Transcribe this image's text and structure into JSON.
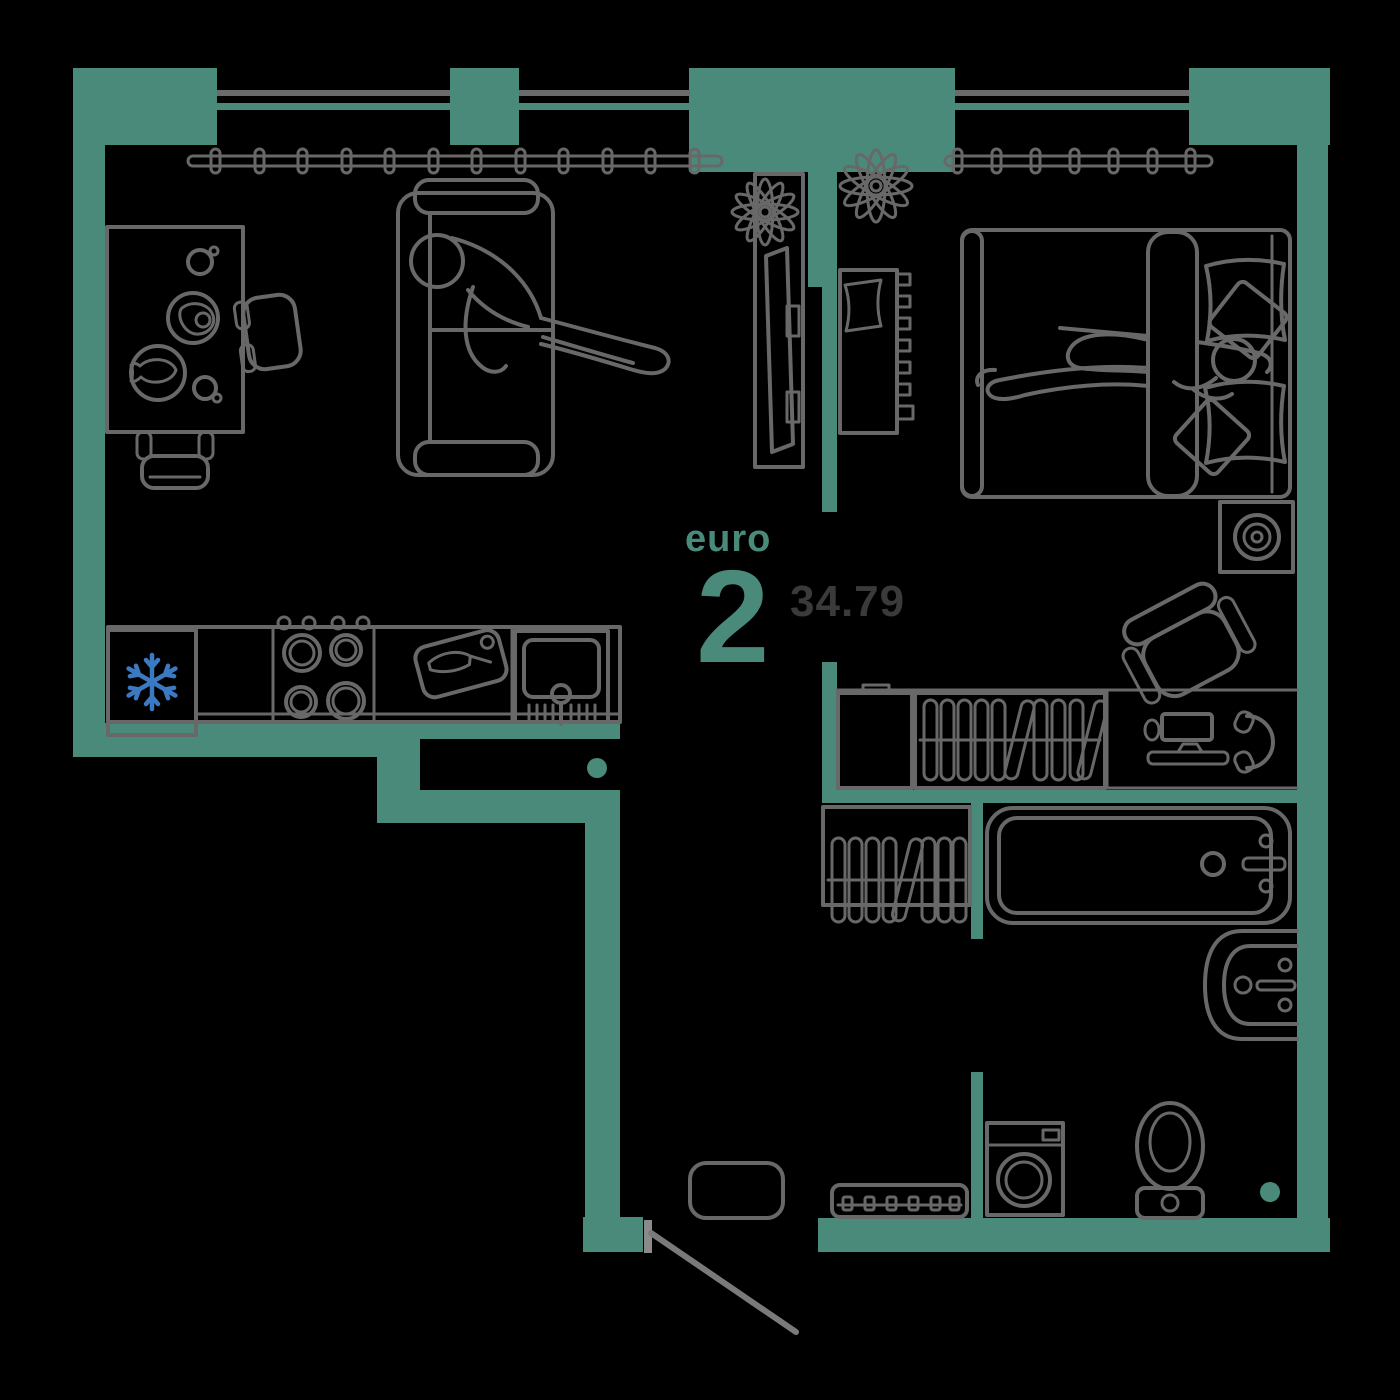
{
  "page": {
    "background": "#000000"
  },
  "plan": {
    "type_label": "euro",
    "rooms_count": "2",
    "area_value": "34.79",
    "colors": {
      "wall": "#4A8A7B",
      "furniture_line": "#686868",
      "label_text": "#4A8A7B",
      "area_text": "#3A3A3A",
      "snowflake_blue": "#3B7AC2",
      "background": "#000000"
    },
    "icons": [
      "window",
      "curtain-rod-icon",
      "sofa-icon",
      "person-icon",
      "dining-table-icon",
      "chair-icon",
      "tv-stand-icon",
      "plant-icon",
      "fridge-icon",
      "snowflake-icon",
      "stove-icon",
      "cutting-board-icon",
      "kitchen-sink-icon",
      "bed-icon",
      "pillow-icon",
      "radiator-shelf-icon",
      "nightstand-lamp-icon",
      "closet-icon",
      "wardrobe-hangers-icon",
      "desk-monitor-icon",
      "mouse-icon",
      "keyboard-icon",
      "headphones-icon",
      "office-chair-icon",
      "drying-rack-icon",
      "bathtub-icon",
      "washbasin-icon",
      "toilet-icon",
      "washing-machine-icon",
      "entrance-door-swing",
      "rug-icon",
      "shoe-bench-icon"
    ]
  }
}
